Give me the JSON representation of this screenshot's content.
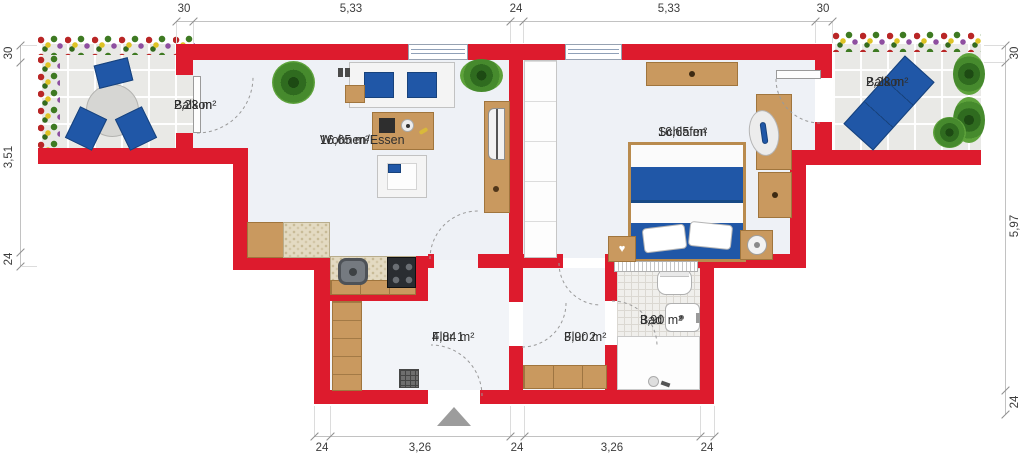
{
  "plan": {
    "rooms": [
      {
        "name": "Balkon",
        "area": "2,23 m²"
      },
      {
        "name": "Wohnen/Essen",
        "area": "16,65 m²"
      },
      {
        "name": "Schlafen",
        "area": "16,65 m²"
      },
      {
        "name": "Balkon",
        "area": "2,23 m²"
      },
      {
        "name": "Flur 1",
        "area": "4,84 m²"
      },
      {
        "name": "Flur 2",
        "area": "3,90 m²"
      },
      {
        "name": "Bad",
        "area": "3,90 m²"
      }
    ],
    "dimensions": {
      "top": [
        "30",
        "5,33",
        "24",
        "5,33",
        "30"
      ],
      "bottom": [
        "24",
        "3,26",
        "24",
        "3,26",
        "24"
      ],
      "left": [
        "30",
        "3,51",
        "24"
      ],
      "right": [
        "30",
        "5,97",
        "24"
      ]
    },
    "colors": {
      "wall": "#dd1b2d",
      "accent_blue": "#2057a7",
      "wood": "#c9995f"
    },
    "icons": {
      "heart": "♥"
    }
  }
}
